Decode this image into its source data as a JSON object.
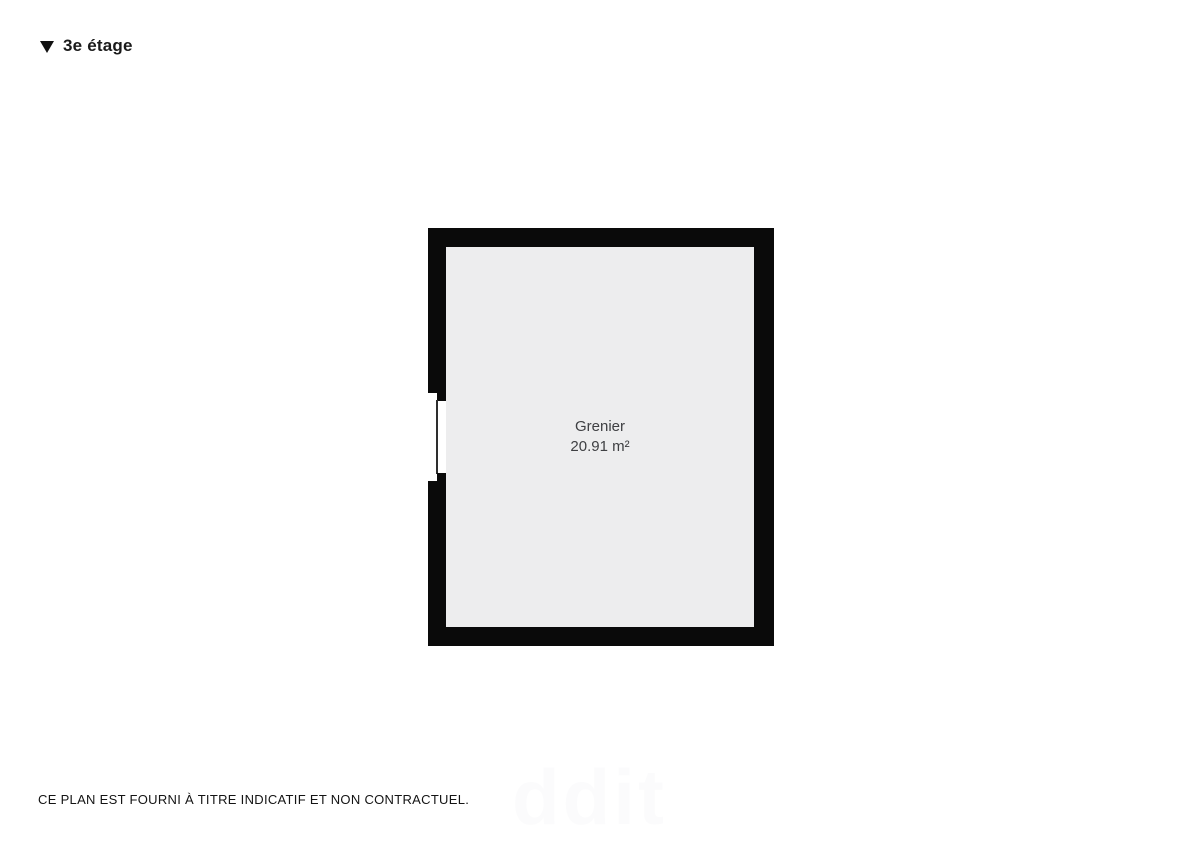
{
  "header": {
    "floor_label": "3e étage",
    "marker_icon": "triangle-down-icon",
    "text_color": "#1a1a1a"
  },
  "floorplan": {
    "room": {
      "name": "Grenier",
      "area": "20.91 m²"
    },
    "features": [
      "window-left-wall"
    ],
    "colors": {
      "wall": "#0a0a0a",
      "floor": "#ededee",
      "label": "#3f4043"
    }
  },
  "footer": {
    "disclaimer": "CE PLAN EST FOURNI À TITRE INDICATIF ET NON CONTRACTUEL.",
    "watermark_text": "ddit",
    "watermark_color": "#fbfbfc"
  }
}
